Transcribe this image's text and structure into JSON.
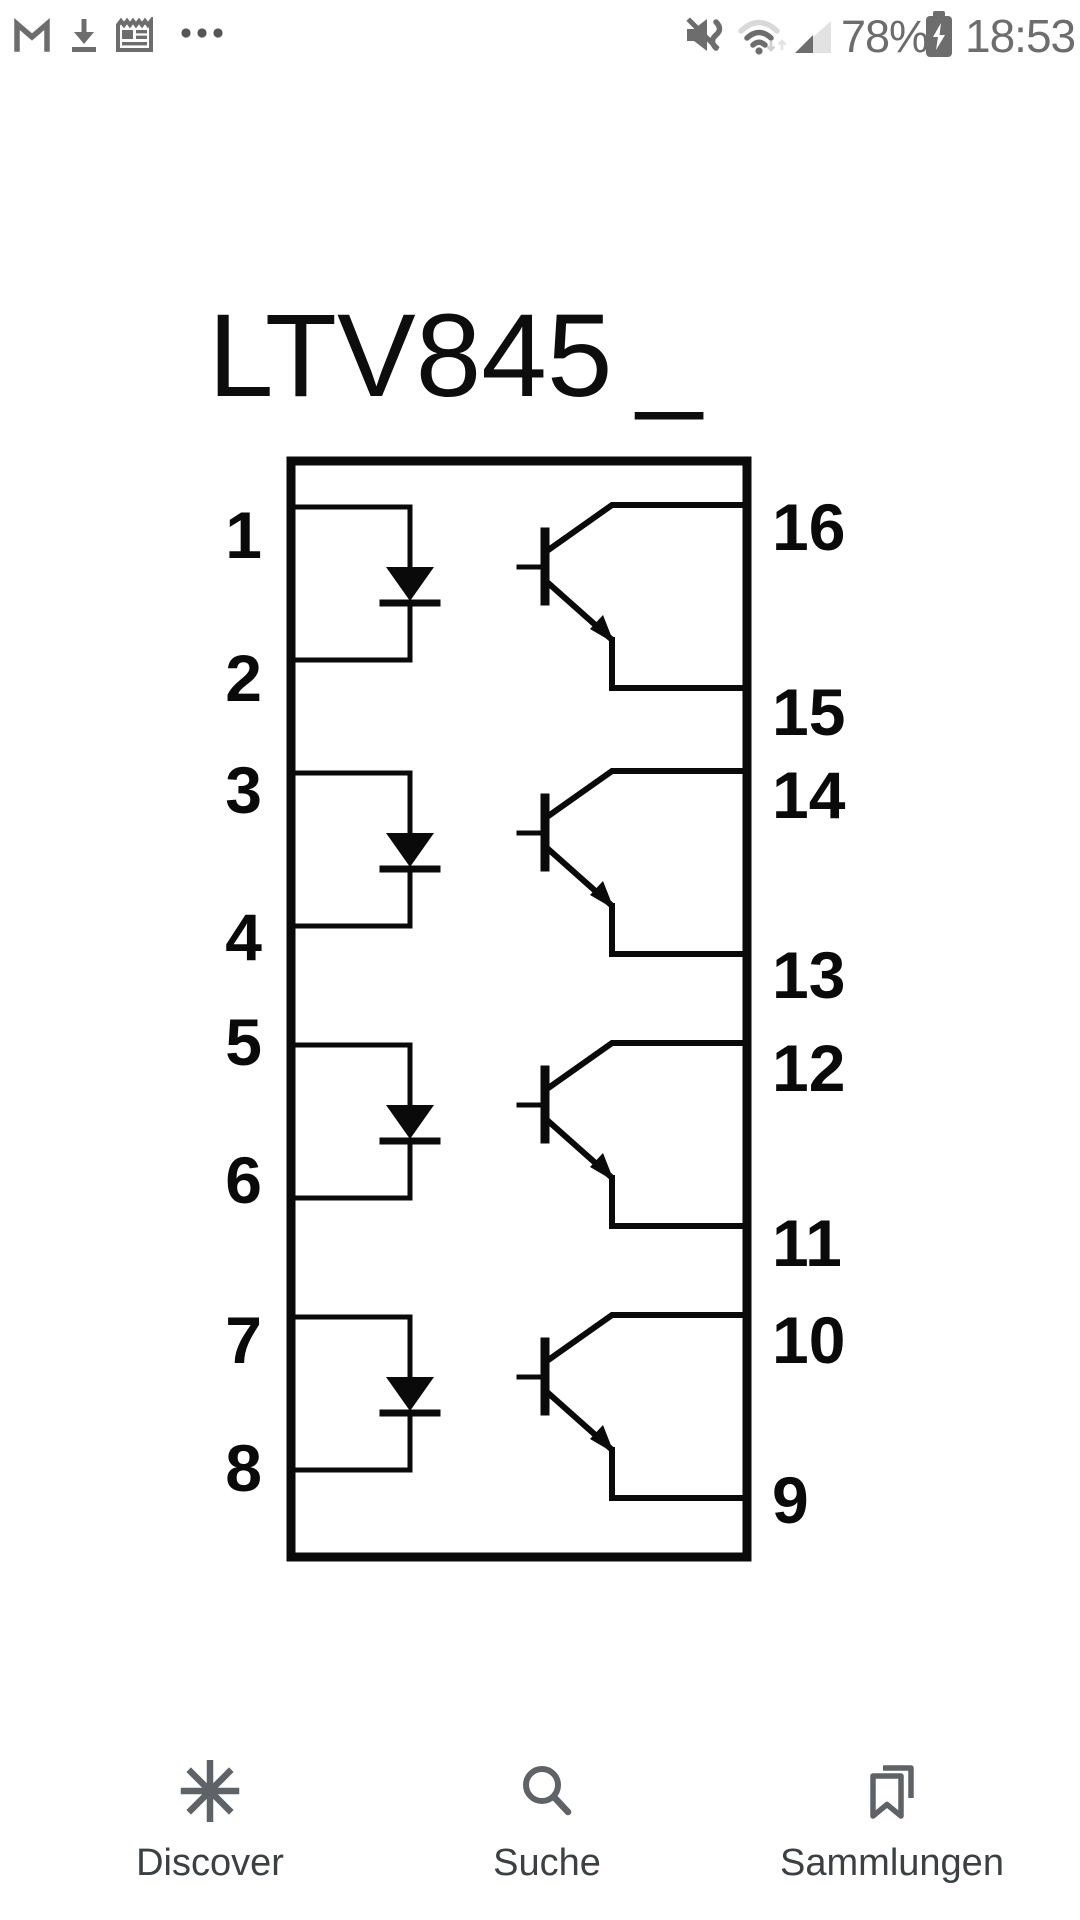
{
  "status_bar": {
    "time": "18:53",
    "battery_percent": "78%",
    "battery_state": "charging",
    "notification_icons": [
      "gmail-icon",
      "download-icon",
      "news-icon",
      "more-notifications-icon"
    ],
    "system_icons": [
      "mute-vibrate-icon",
      "wifi-icon",
      "cell-signal-icon",
      "battery-charging-icon"
    ],
    "wifi_strength": "2-of-3-arcs",
    "cell_signal_strength": "2-of-4-bars"
  },
  "image": {
    "title": "LTV845",
    "title_suffix": "_",
    "description": "optocoupler pinout diagram, 16-pin package, 4 channels"
  },
  "schematic": {
    "left_pins": [
      "1",
      "2",
      "3",
      "4",
      "5",
      "6",
      "7",
      "8"
    ],
    "right_pins": [
      "16",
      "15",
      "14",
      "13",
      "12",
      "11",
      "10",
      "9"
    ],
    "channels": 4,
    "channel_components": [
      "led-diode-symbol",
      "phototransistor-symbol"
    ],
    "ink_color": "#0a0a0a"
  },
  "bottom_nav": {
    "items": [
      {
        "label": "Discover",
        "icon": "discover-asterisk-icon"
      },
      {
        "label": "Suche",
        "icon": "search-icon"
      },
      {
        "label": "Sammlungen",
        "icon": "collections-bookmark-icon"
      }
    ]
  },
  "colors": {
    "ink": "#0a0a0a",
    "status_gray": "#6d6d6d",
    "status_light_gray": "#d9d9d9",
    "nav_icon_gray": "#5f6368",
    "nav_label_gray": "#3c4043",
    "background": "#ffffff"
  }
}
